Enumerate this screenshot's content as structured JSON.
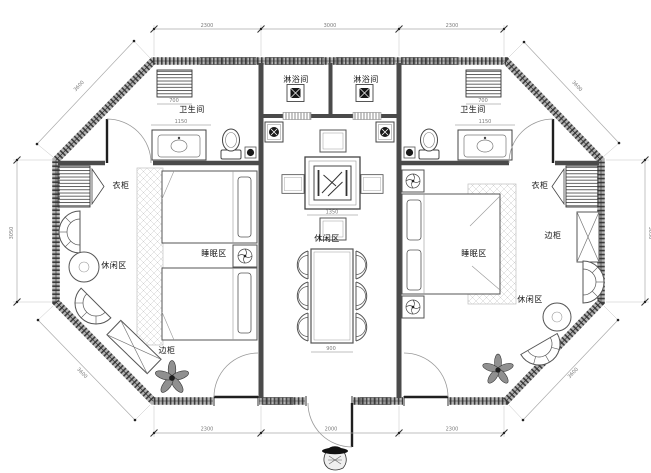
{
  "rooms": {
    "shower": "淋浴间",
    "bathroom": "卫生间",
    "wardrobe": "衣柜",
    "side_cabinet": "边柜",
    "sleeping": "睡眠区",
    "leisure": "休闲区"
  },
  "dimensions": {
    "top": [
      "2300",
      "3000",
      "2300"
    ],
    "bottom": [
      "2300",
      "2000",
      "2300"
    ],
    "left": "3050",
    "right": "3050",
    "diagonal": "3600",
    "closet": "700",
    "bath_width": "1150",
    "tea_table": "1350",
    "dining": "900"
  },
  "colors": {
    "wall": "#555555",
    "line": "#444444",
    "dim_text": "#7a7a7a",
    "label_text": "#141414",
    "hatch": "#c8c8c8"
  }
}
